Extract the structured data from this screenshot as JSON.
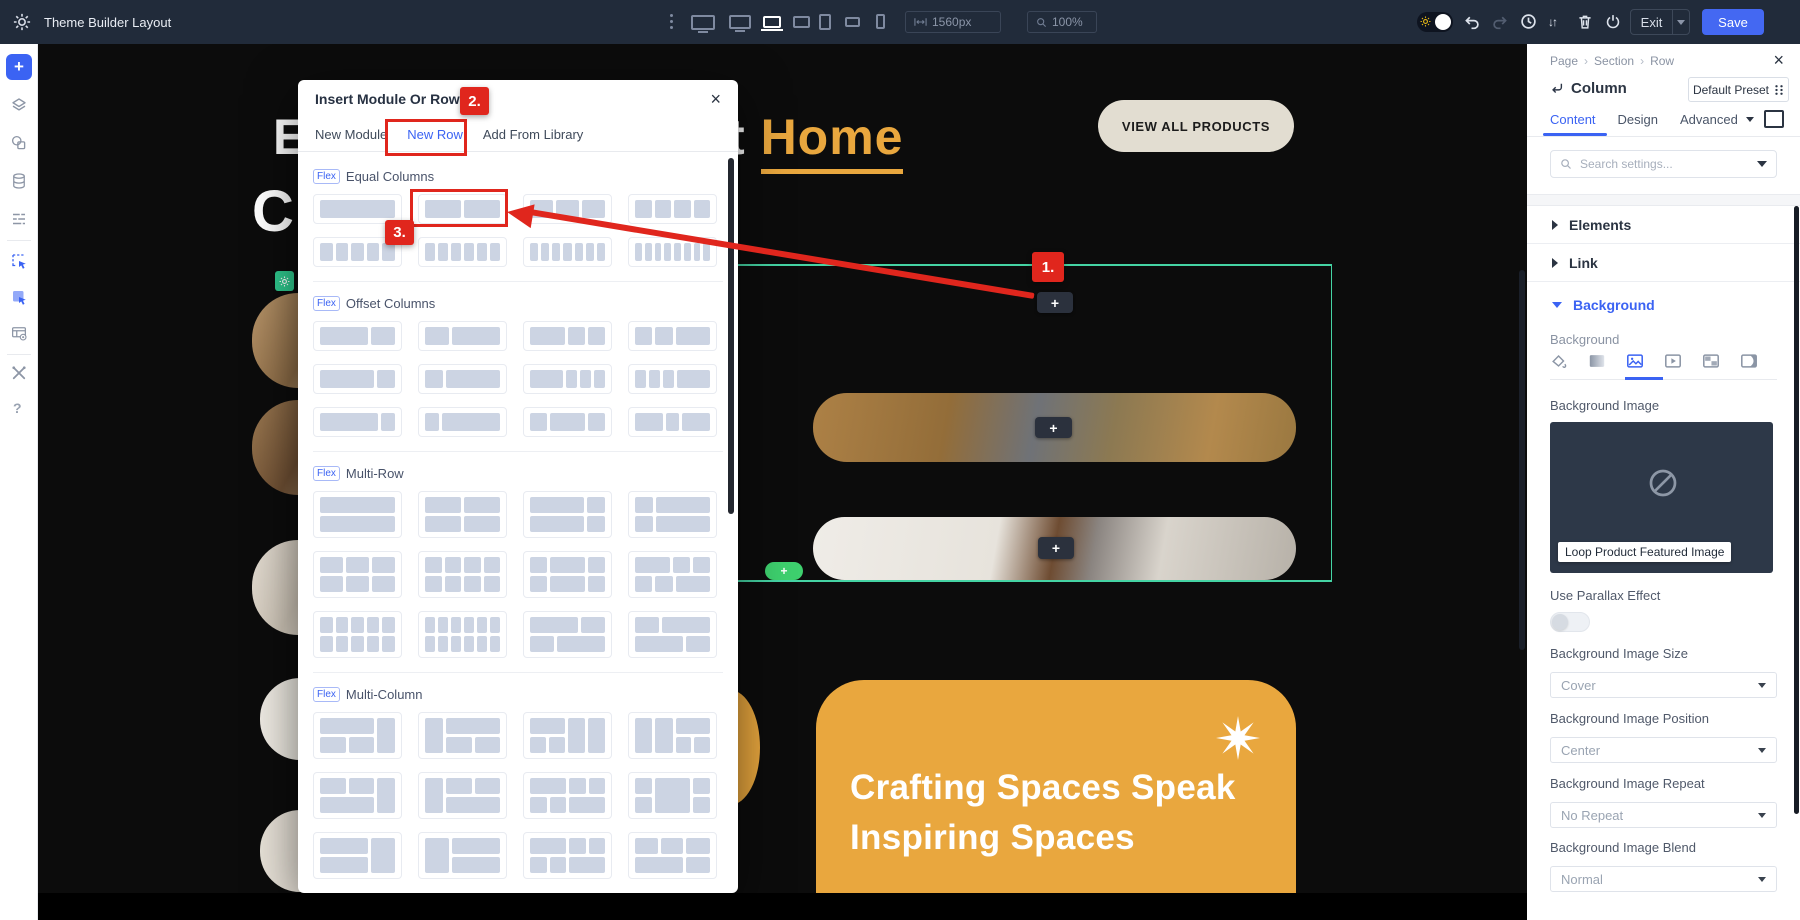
{
  "top_bar": {
    "title": "Theme Builder Layout",
    "width_value": "1560px",
    "zoom_value": "100%",
    "exit_label": "Exit",
    "save_label": "Save"
  },
  "left_sidebar": {
    "icons": [
      "add",
      "layers",
      "design",
      "database",
      "fields",
      "select-module",
      "select-module-filled",
      "theme-builder-settings",
      "tools",
      "help"
    ],
    "help_label": "?"
  },
  "canvas": {
    "heading_fragment_1": "E",
    "heading_fragment_2": "C",
    "heading_pre": "t",
    "heading_link": "Home",
    "view_all_button": "VIEW ALL PRODUCTS",
    "plus_icon": "+",
    "card_line_1": "Crafting Spaces Speak",
    "card_line_2": "Inspiring Spaces"
  },
  "modal": {
    "title": "Insert Module Or Row",
    "close_icon": "×",
    "tabs": [
      {
        "label": "New Module",
        "active": false
      },
      {
        "label": "New Row",
        "active": true
      },
      {
        "label": "Add From Library",
        "active": false
      }
    ],
    "flex_badge": "Flex",
    "sections": [
      {
        "label": "Equal Columns",
        "type": "bars",
        "thumb_h": 30,
        "rows": [
          [
            [
              1
            ],
            [
              1,
              1
            ],
            [
              1,
              1,
              1
            ],
            [
              1,
              1,
              1,
              1
            ]
          ],
          [
            [
              1,
              1,
              1,
              1,
              1
            ],
            [
              1,
              1,
              1,
              1,
              1,
              1
            ],
            [
              1,
              1,
              1,
              1,
              1,
              1,
              1
            ],
            [
              1,
              1,
              1,
              1,
              1,
              1,
              1,
              1
            ]
          ]
        ]
      },
      {
        "label": "Offset Columns",
        "type": "bars",
        "thumb_h": 30,
        "rows": [
          [
            [
              2,
              1
            ],
            [
              1,
              2
            ],
            [
              2,
              1,
              1
            ],
            [
              1,
              1,
              2
            ]
          ],
          [
            [
              3,
              1
            ],
            [
              1,
              3
            ],
            [
              3,
              1,
              1,
              1
            ],
            [
              1,
              1,
              1,
              3
            ]
          ],
          [
            [
              4,
              1
            ],
            [
              1,
              4
            ],
            [
              1,
              2,
              1
            ],
            [
              2,
              1,
              2
            ]
          ]
        ]
      },
      {
        "label": "Multi-Row",
        "type": "stack",
        "thumb_h": 47,
        "rows": [
          [
            [
              [
                1
              ],
              [
                1
              ]
            ],
            [
              [
                1,
                1
              ],
              [
                1,
                1
              ]
            ],
            [
              [
                3,
                1
              ],
              [
                3,
                1
              ]
            ],
            [
              [
                1,
                3
              ],
              [
                1,
                3
              ]
            ]
          ],
          [
            [
              [
                1,
                1,
                1
              ],
              [
                1,
                1,
                1
              ]
            ],
            [
              [
                1,
                1,
                1,
                1
              ],
              [
                1,
                1,
                1,
                1
              ]
            ],
            [
              [
                1,
                2,
                1
              ],
              [
                1,
                2,
                1
              ]
            ],
            [
              [
                2,
                1,
                1
              ],
              [
                1,
                1,
                2
              ]
            ]
          ],
          [
            [
              [
                1,
                1,
                1,
                1,
                1
              ],
              [
                1,
                1,
                1,
                1,
                1
              ]
            ],
            [
              [
                1,
                1,
                1,
                1,
                1,
                1
              ],
              [
                1,
                1,
                1,
                1,
                1,
                1
              ]
            ],
            [
              [
                2,
                1
              ],
              [
                1,
                2
              ]
            ],
            [
              [
                1,
                2
              ],
              [
                2,
                1
              ]
            ]
          ]
        ]
      },
      {
        "label": "Multi-Column",
        "type": "columns",
        "thumb_h": 47,
        "rows": [
          [
            {
              "cols": [
                {
                  "w": 3,
                  "rows": [
                    1,
                    2
                  ]
                },
                {
                  "w": 1,
                  "rows": [
                    1
                  ]
                }
              ]
            },
            {
              "cols": [
                {
                  "w": 1,
                  "rows": [
                    1
                  ]
                },
                {
                  "w": 3,
                  "rows": [
                    1,
                    2
                  ]
                }
              ]
            },
            {
              "cols": [
                {
                  "w": 2,
                  "rows": [
                    1,
                    2
                  ]
                },
                {
                  "w": 1,
                  "rows": [
                    1
                  ]
                },
                {
                  "w": 1,
                  "rows": [
                    1
                  ]
                }
              ]
            },
            {
              "cols": [
                {
                  "w": 1,
                  "rows": [
                    1
                  ]
                },
                {
                  "w": 1,
                  "rows": [
                    1
                  ]
                },
                {
                  "w": 2,
                  "rows": [
                    1,
                    2
                  ]
                }
              ]
            }
          ],
          [
            {
              "cols": [
                {
                  "w": 3,
                  "rows": [
                    2,
                    1
                  ]
                },
                {
                  "w": 1,
                  "rows": [
                    1
                  ]
                }
              ]
            },
            {
              "cols": [
                {
                  "w": 1,
                  "rows": [
                    1
                  ]
                },
                {
                  "w": 3,
                  "rows": [
                    2,
                    1
                  ]
                }
              ]
            },
            {
              "cols": [
                {
                  "w": 2,
                  "rows": [
                    1,
                    2
                  ]
                },
                {
                  "w": 2,
                  "rows": [
                    2,
                    1
                  ]
                }
              ]
            },
            {
              "cols": [
                {
                  "w": 1,
                  "rows": [
                    1,
                    1
                  ]
                },
                {
                  "w": 2,
                  "rows": [
                    1
                  ]
                },
                {
                  "w": 1,
                  "rows": [
                    1,
                    1
                  ]
                }
              ]
            }
          ],
          [
            {
              "cols": [
                {
                  "w": 2,
                  "rows": [
                    1,
                    1
                  ]
                },
                {
                  "w": 1,
                  "rows": [
                    1
                  ]
                }
              ]
            },
            {
              "cols": [
                {
                  "w": 1,
                  "rows": [
                    1
                  ]
                },
                {
                  "w": 2,
                  "rows": [
                    1,
                    1
                  ]
                }
              ]
            },
            {
              "cols": [
                {
                  "w": 1,
                  "rows": [
                    1,
                    2
                  ]
                },
                {
                  "w": 1,
                  "rows": [
                    2,
                    1
                  ]
                }
              ]
            },
            {
              "cols": [
                {
                  "w": 2,
                  "rows": [
                    2,
                    1
                  ]
                },
                {
                  "w": 1,
                  "rows": [
                    1,
                    1
                  ]
                }
              ]
            }
          ]
        ]
      }
    ]
  },
  "annotations": {
    "step_1": "1.",
    "step_2": "2.",
    "step_3": "3."
  },
  "panel": {
    "breadcrumb": [
      "Page",
      "Section",
      "Row"
    ],
    "close_icon": "×",
    "title": "Column",
    "preset_button": "Default Preset",
    "tabs": [
      "Content",
      "Design",
      "Advanced"
    ],
    "active_tab": "Content",
    "search_placeholder": "Search settings...",
    "groups": [
      "Elements",
      "Link",
      "Background"
    ],
    "background": {
      "label": "Background",
      "types": [
        "color",
        "gradient",
        "image",
        "video",
        "pattern",
        "mask"
      ],
      "active_type": "image",
      "image_label": "Background Image",
      "image_tooltip": "Loop Product Featured Image",
      "parallax_label": "Use Parallax Effect",
      "parallax_on": false,
      "fields": [
        {
          "label": "Background Image Size",
          "value": "Cover"
        },
        {
          "label": "Background Image Position",
          "value": "Center"
        },
        {
          "label": "Background Image Repeat",
          "value": "No Repeat"
        },
        {
          "label": "Background Image Blend",
          "value": "Normal"
        }
      ]
    }
  },
  "colors": {
    "accent_blue": "#3b63f3",
    "save_blue": "#4468f2",
    "annotation_red": "#e0261d",
    "selection_teal": "#45d4a4",
    "builder_green": "#2fc98e",
    "brand_orange": "#e9a73e"
  }
}
